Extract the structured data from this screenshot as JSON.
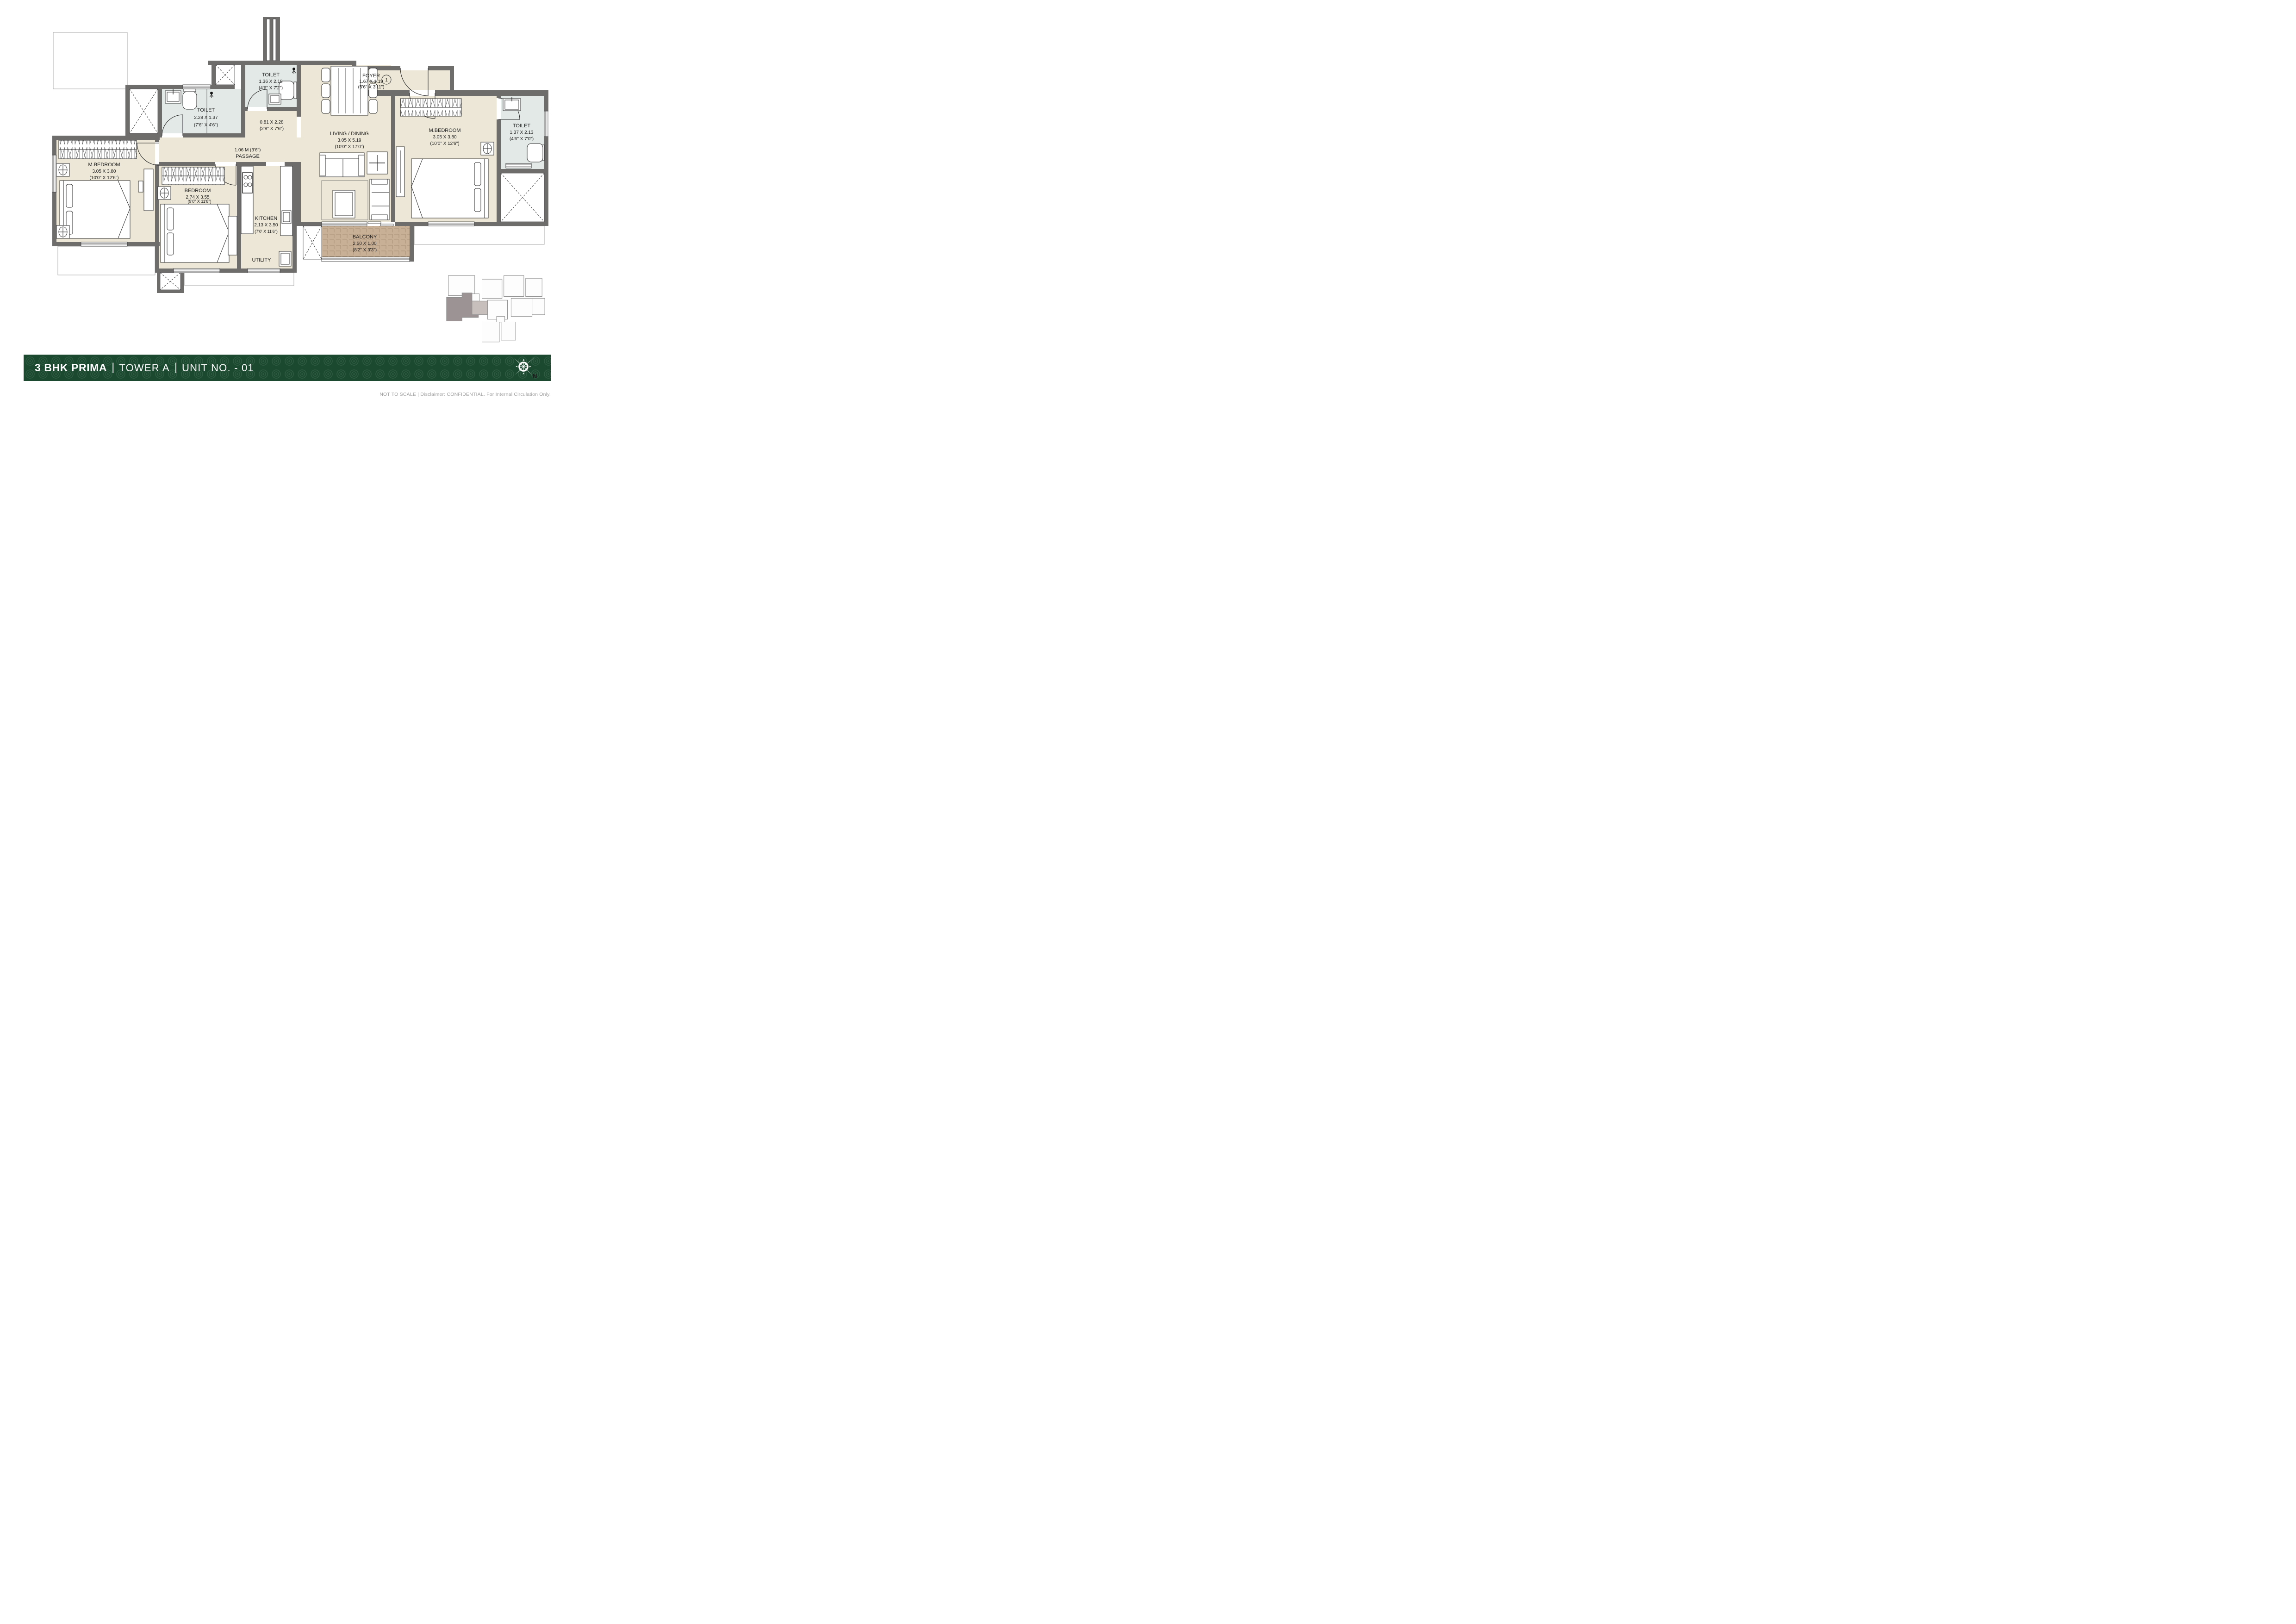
{
  "title": {
    "product": "3 BHK PRIMA",
    "separator": "|",
    "tower": "TOWER A",
    "unit": "UNIT NO. - 01"
  },
  "footer": {
    "note": "NOT TO SCALE | Disclaimer: CONFIDENTIAL. For Internal Circulation Only."
  },
  "compass": {
    "north_label": "N"
  },
  "entrance": {
    "door_number": "1"
  },
  "rooms": {
    "toilet_top": {
      "name": "TOILET",
      "dim_m": "1.36 X 2.18",
      "dim_ft": "(4'6\" X 7'2\")"
    },
    "dining_nook": {
      "dim_m": "0.81 X 2.28",
      "dim_ft": "(2'8\" X 7'6\")"
    },
    "living_dining": {
      "name": "LIVING / DINING",
      "dim_m": "3.05 X 5.19",
      "dim_ft": "(10'0\" X 17'0\")"
    },
    "foyer": {
      "name": "FOYER",
      "dim_m": "1.67 X 1.19",
      "dim_ft": "(5'6\" X 3'11\")"
    },
    "mbedroom_right": {
      "name": "M.BEDROOM",
      "dim_m": "3.05 X 3.80",
      "dim_ft": "(10'0\" X 12'6\")"
    },
    "toilet_right": {
      "name": "TOILET",
      "dim_m": "1.37 X 2.13",
      "dim_ft": "(4'6\" X 7'0\")"
    },
    "toilet_left": {
      "name": "TOILET",
      "dim_m": "2.28 X 1.37",
      "dim_ft": "(7'6\" X 4'6\")"
    },
    "mbedroom_left": {
      "name": "M.BEDROOM",
      "dim_m": "3.05 X 3.80",
      "dim_ft": "(10'0\" X 12'6\")"
    },
    "passage": {
      "dim": "1.06 M (3'6\")",
      "name": "PASSAGE"
    },
    "bedroom": {
      "name": "BEDROOM",
      "dim_m": "2.74 X 3.55",
      "dim_ft": "(9'0\" X 11'8\")"
    },
    "kitchen": {
      "name": "KITCHEN",
      "dim_m": "2.13 X 3.50",
      "dim_ft": "(7'0' X 11'6\")"
    },
    "utility": {
      "name": "UTILITY"
    },
    "balcony": {
      "name": "BALCONY",
      "dim_m": "2.50 X 1.00",
      "dim_ft": "(8'2\" X 3'3\")"
    }
  }
}
